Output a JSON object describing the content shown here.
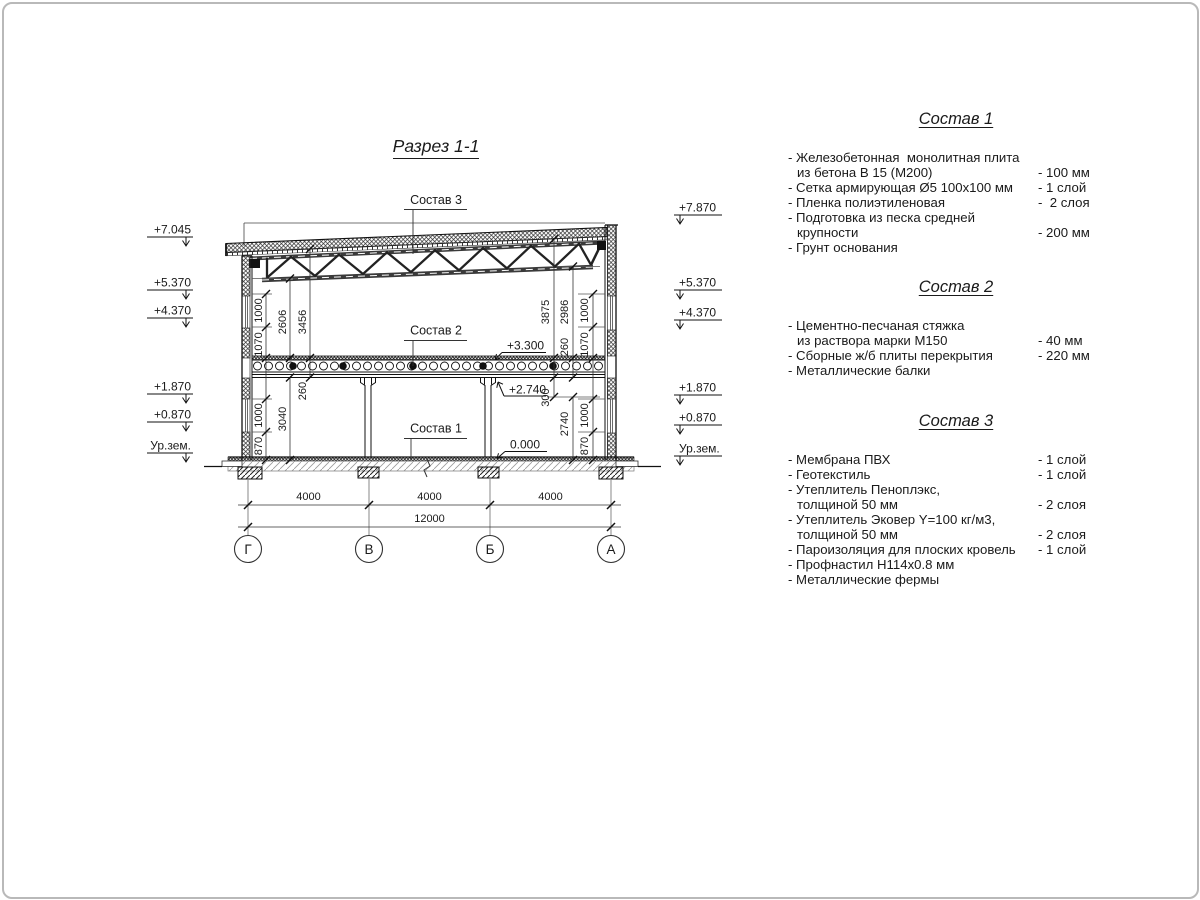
{
  "drawing": {
    "title": "Разрез 1-1",
    "levels_left": [
      "+7.045",
      "+5.370",
      "+4.370",
      "+1.870",
      "+0.870",
      "Ур.зем."
    ],
    "levels_right": [
      "+7.870",
      "+5.370",
      "+4.370",
      "+1.870",
      "+0.870",
      "Ур.зем."
    ],
    "marks_inner": {
      "slab_top": "+3.300",
      "beam_bottom": "+2.740",
      "floor": "0.000"
    },
    "callouts": {
      "c1": "Состав 1",
      "c2": "Состав 2",
      "c3": "Состав 3"
    },
    "dims_left": [
      "1000",
      "1070",
      "2606",
      "3456",
      "260",
      "3040",
      "1000",
      "870"
    ],
    "dims_right": [
      "3875",
      "2986",
      "1000",
      "260",
      "1070",
      "300",
      "2740",
      "1000",
      "870"
    ],
    "dims_bottom": [
      "4000",
      "4000",
      "4000",
      "12000"
    ],
    "axes": [
      "Г",
      "В",
      "Б",
      "А"
    ]
  },
  "compositions": [
    {
      "title": "Состав 1",
      "items": [
        {
          "text": "- Железобетонная  монолитная плита",
          "value": "",
          "indent": false
        },
        {
          "text": "из бетона В 15 (М200)",
          "value": "- 100 мм",
          "indent": true
        },
        {
          "text": "- Сетка армирующая Ø5 100х100 мм",
          "value": "- 1 слой",
          "indent": false
        },
        {
          "text": "- Пленка полиэтиленовая",
          "value": "-  2 слоя",
          "indent": false
        },
        {
          "text": "- Подготовка из песка средней",
          "value": "",
          "indent": false
        },
        {
          "text": "крупности",
          "value": "- 200 мм",
          "indent": true
        },
        {
          "text": "- Грунт основания",
          "value": "",
          "indent": false
        }
      ]
    },
    {
      "title": "Состав 2",
      "items": [
        {
          "text": "- Цементно-песчаная стяжка",
          "value": "",
          "indent": false
        },
        {
          "text": "из раствора марки М150",
          "value": "- 40 мм",
          "indent": true
        },
        {
          "text": "- Сборные ж/б плиты перекрытия",
          "value": "- 220 мм",
          "indent": false
        },
        {
          "text": "- Металлические балки",
          "value": "",
          "indent": false
        }
      ]
    },
    {
      "title": "Состав 3",
      "items": [
        {
          "text": "- Мембрана ПВХ",
          "value": "- 1 слой",
          "indent": false
        },
        {
          "text": "- Геотекстиль",
          "value": "- 1 слой",
          "indent": false
        },
        {
          "text": "- Утеплитель Пеноплэкс,",
          "value": "",
          "indent": false
        },
        {
          "text": "толщиной 50 мм",
          "value": "- 2 слоя",
          "indent": true
        },
        {
          "text": "- Утеплитель Эковер Y=100 кг/м3,",
          "value": "",
          "indent": false
        },
        {
          "text": "толщиной 50 мм",
          "value": "- 2 слоя",
          "indent": true
        },
        {
          "text": "- Пароизоляция для плоских кровель",
          "value": "- 1 слой",
          "indent": false
        },
        {
          "text": "- Профнастил Н114х0.8 мм",
          "value": "",
          "indent": false
        },
        {
          "text": "- Металлические фермы",
          "value": "",
          "indent": false
        }
      ]
    }
  ]
}
